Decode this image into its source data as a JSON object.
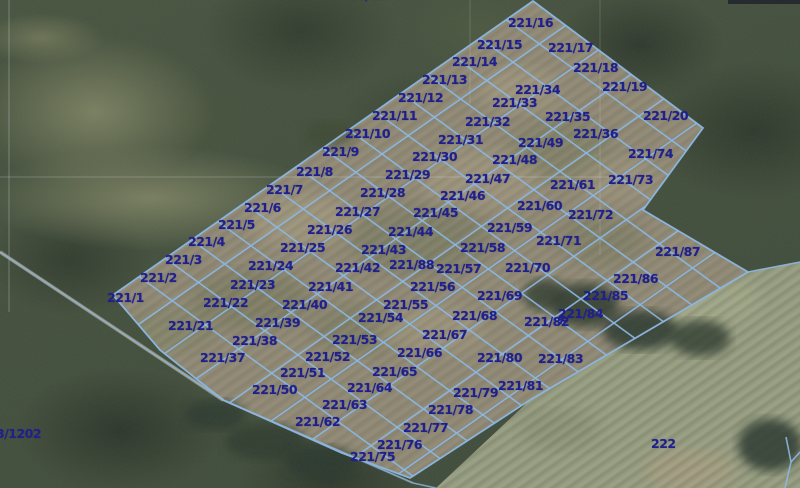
{
  "map": {
    "type": "cadastral-parcel-overlay-on-aerial-imagery",
    "colors": {
      "parcel_line": "#8cb7e3",
      "label_text": "#20208c",
      "field_fill": "#8d8672",
      "se_field_fill": "#93997c",
      "track_fill": "#b3a98f"
    },
    "parcel_labels": [
      [
        "221/1",
        107,
        292
      ],
      [
        "221/2",
        140,
        272
      ],
      [
        "221/3",
        165,
        254
      ],
      [
        "221/4",
        188,
        236
      ],
      [
        "221/5",
        218,
        219
      ],
      [
        "221/6",
        244,
        202
      ],
      [
        "221/7",
        266,
        184
      ],
      [
        "221/8",
        296,
        166
      ],
      [
        "221/9",
        322,
        146
      ],
      [
        "221/10",
        345,
        128
      ],
      [
        "221/11",
        372,
        110
      ],
      [
        "221/12",
        398,
        92
      ],
      [
        "221/13",
        422,
        74
      ],
      [
        "221/14",
        452,
        56
      ],
      [
        "221/15",
        477,
        39
      ],
      [
        "221/16",
        508,
        17
      ],
      [
        "221/17",
        548,
        42
      ],
      [
        "221/18",
        573,
        62
      ],
      [
        "221/19",
        602,
        81
      ],
      [
        "221/20",
        643,
        110
      ],
      [
        "221/21",
        168,
        320
      ],
      [
        "221/22",
        203,
        297
      ],
      [
        "221/23",
        230,
        279
      ],
      [
        "221/24",
        248,
        260
      ],
      [
        "221/25",
        280,
        242
      ],
      [
        "221/26",
        307,
        224
      ],
      [
        "221/27",
        335,
        206
      ],
      [
        "221/28",
        360,
        187
      ],
      [
        "221/29",
        385,
        169
      ],
      [
        "221/30",
        412,
        151
      ],
      [
        "221/31",
        438,
        134
      ],
      [
        "221/32",
        465,
        116
      ],
      [
        "221/33",
        492,
        97
      ],
      [
        "221/34",
        515,
        84
      ],
      [
        "221/35",
        545,
        111
      ],
      [
        "221/36",
        573,
        128
      ],
      [
        "221/37",
        200,
        352
      ],
      [
        "221/38",
        232,
        335
      ],
      [
        "221/39",
        255,
        317
      ],
      [
        "221/40",
        282,
        299
      ],
      [
        "221/41",
        308,
        281
      ],
      [
        "221/42",
        335,
        262
      ],
      [
        "221/43",
        361,
        244
      ],
      [
        "221/44",
        388,
        226
      ],
      [
        "221/45",
        413,
        207
      ],
      [
        "221/46",
        440,
        190
      ],
      [
        "221/47",
        465,
        173
      ],
      [
        "221/48",
        492,
        154
      ],
      [
        "221/49",
        518,
        137
      ],
      [
        "221/50",
        252,
        384
      ],
      [
        "221/51",
        280,
        367
      ],
      [
        "221/52",
        305,
        351
      ],
      [
        "221/53",
        332,
        334
      ],
      [
        "221/54",
        358,
        312
      ],
      [
        "221/55",
        383,
        299
      ],
      [
        "221/56",
        410,
        281
      ],
      [
        "221/57",
        436,
        263
      ],
      [
        "221/58",
        460,
        242
      ],
      [
        "221/59",
        487,
        222
      ],
      [
        "221/60",
        517,
        200
      ],
      [
        "221/61",
        550,
        179
      ],
      [
        "221/62",
        295,
        416
      ],
      [
        "221/63",
        322,
        399
      ],
      [
        "221/64",
        347,
        382
      ],
      [
        "221/65",
        372,
        366
      ],
      [
        "221/66",
        397,
        347
      ],
      [
        "221/67",
        422,
        329
      ],
      [
        "221/68",
        452,
        310
      ],
      [
        "221/69",
        477,
        290
      ],
      [
        "221/70",
        505,
        262
      ],
      [
        "221/71",
        536,
        235
      ],
      [
        "221/72",
        568,
        209
      ],
      [
        "221/73",
        608,
        174
      ],
      [
        "221/74",
        628,
        148
      ],
      [
        "221/75",
        350,
        451
      ],
      [
        "221/76",
        377,
        439
      ],
      [
        "221/77",
        403,
        422
      ],
      [
        "221/78",
        428,
        404
      ],
      [
        "221/79",
        453,
        387
      ],
      [
        "221/80",
        477,
        352
      ],
      [
        "221/81",
        498,
        380
      ],
      [
        "221/82",
        524,
        316
      ],
      [
        "221/83",
        538,
        353
      ],
      [
        "221/84",
        558,
        308
      ],
      [
        "221/85",
        583,
        290
      ],
      [
        "221/86",
        613,
        273
      ],
      [
        "221/87",
        655,
        246
      ],
      [
        "221/88",
        389,
        259
      ]
    ],
    "annotations": [
      [
        "3/1202",
        -4,
        428
      ],
      [
        "222",
        651,
        438
      ],
      [
        "31/1200",
        349,
        -10
      ]
    ],
    "point_marker": {
      "x": 558,
      "y": 315
    },
    "geometry": {
      "block_outline": [
        [
          113,
          295
        ],
        [
          533,
          1
        ],
        [
          703,
          128
        ],
        [
          643,
          210
        ],
        [
          748,
          272
        ],
        [
          530,
          400
        ],
        [
          410,
          478
        ],
        [
          342,
          453
        ],
        [
          223,
          400
        ],
        [
          160,
          350
        ]
      ],
      "se_field": [
        [
          436,
          488
        ],
        [
          530,
          400
        ],
        [
          748,
          272
        ],
        [
          800,
          262
        ],
        [
          800,
          488
        ]
      ],
      "grid": {
        "origin": [
          113,
          295
        ],
        "a": [
          0.8192,
          -0.5734
        ],
        "b": [
          0.808,
          0.589
        ],
        "col_spacing": 32,
        "cols": 16,
        "band_spacing": 41,
        "bands": 8,
        "a_extent": [
          -30,
          570
        ],
        "b_extent": [
          -20,
          400
        ]
      },
      "track_line": [
        [
          0,
          252
        ],
        [
          223,
          400
        ],
        [
          413,
          483
        ],
        [
          436,
          488
        ]
      ],
      "branch_line": [
        [
          748,
          272
        ],
        [
          800,
          262
        ]
      ],
      "corner_parcel_lines": [
        [
          [
            786,
            437
          ],
          [
            791,
            462
          ],
          [
            785,
            488
          ]
        ],
        [
          [
            800,
            452
          ],
          [
            791,
            462
          ]
        ]
      ],
      "seam_lines": [
        {
          "pts": [
            [
              9,
              0
            ],
            [
              9,
              312
            ]
          ],
          "opacity": 0.28
        },
        {
          "pts": [
            [
              0,
              177
            ],
            [
              612,
              177
            ]
          ],
          "opacity": 0.22
        },
        {
          "pts": [
            [
              600,
              0
            ],
            [
              600,
              255
            ]
          ],
          "opacity": 0.16
        },
        {
          "pts": [
            [
              470,
              0
            ],
            [
              470,
              103
            ]
          ],
          "opacity": 0.16
        }
      ]
    }
  }
}
